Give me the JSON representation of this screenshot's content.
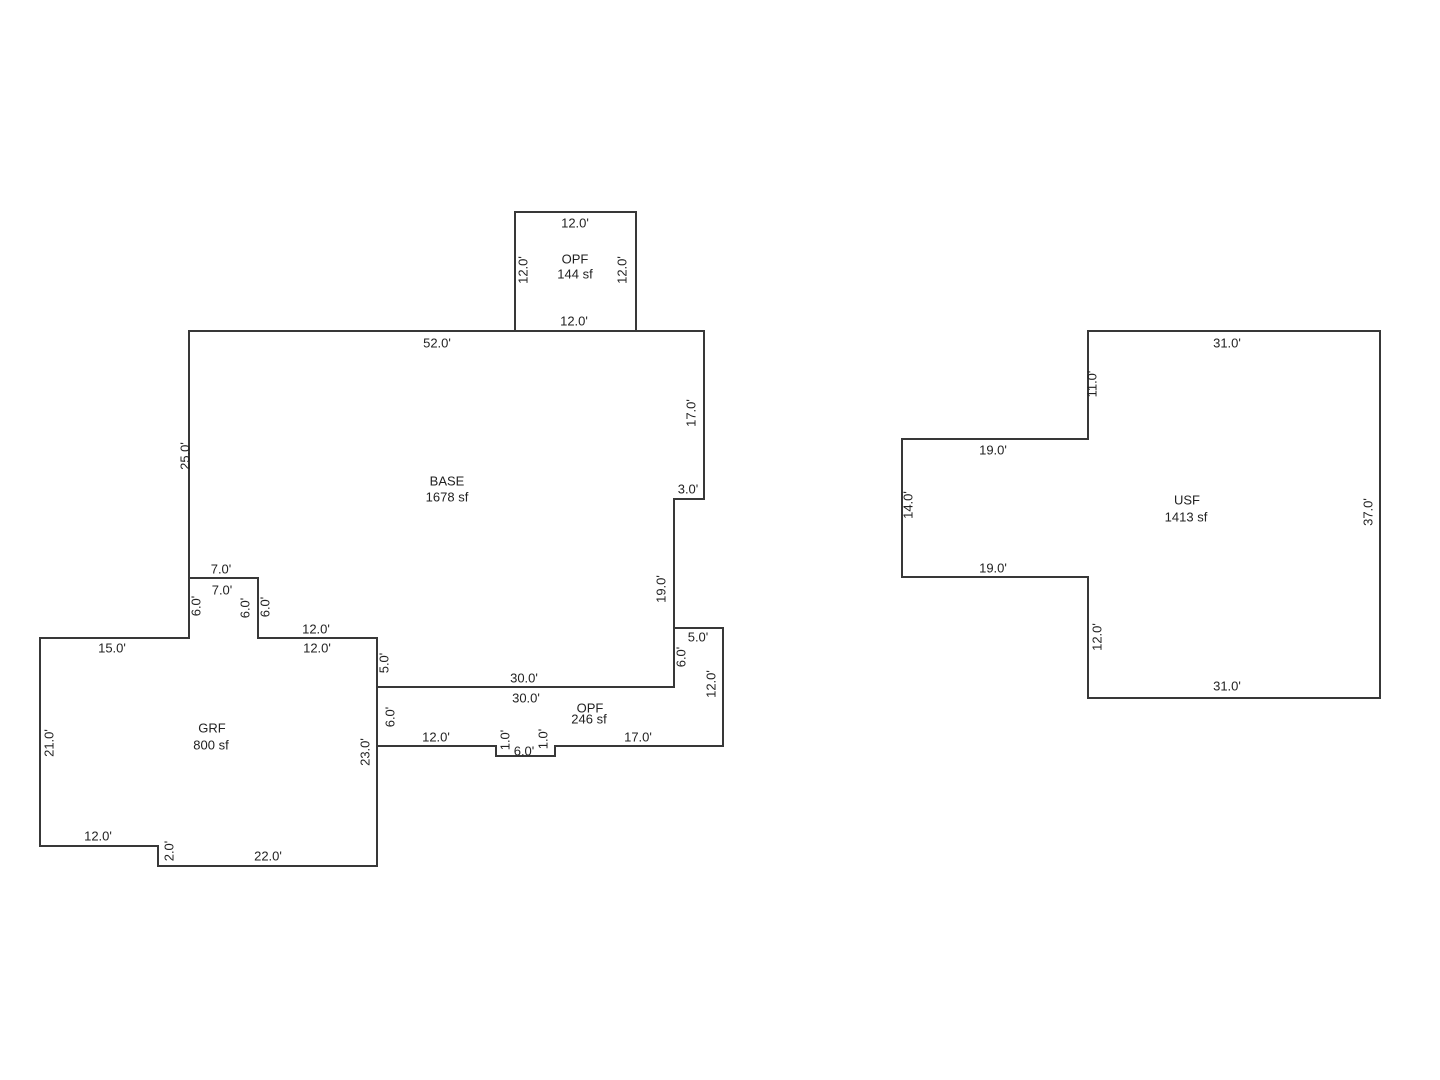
{
  "sketch": {
    "title": "Floor plan sketch",
    "canvas": {
      "width": 1440,
      "height": 1080,
      "background": "#ffffff"
    },
    "colors": {
      "line": "#383838",
      "text": "#222222"
    },
    "areas": [
      {
        "id": "opf-upper",
        "name": "OPF",
        "square_feet": "144 sf",
        "name_pos": [
          575,
          259
        ],
        "sf_pos": [
          575,
          274
        ],
        "points": [
          [
            515,
            212
          ],
          [
            636,
            212
          ],
          [
            636,
            331
          ],
          [
            515,
            331
          ]
        ],
        "dimensions": [
          {
            "text": "12.0'",
            "x": 575,
            "y": 223,
            "rot": 0
          },
          {
            "text": "12.0'",
            "x": 523,
            "y": 270,
            "rot": 90
          },
          {
            "text": "12.0'",
            "x": 622,
            "y": 270,
            "rot": 90
          },
          {
            "text": "12.0'",
            "x": 574,
            "y": 321,
            "rot": 0
          }
        ]
      },
      {
        "id": "base",
        "name": "BASE",
        "square_feet": "1678 sf",
        "name_pos": [
          447,
          481
        ],
        "sf_pos": [
          447,
          497
        ],
        "points": [
          [
            189,
            331
          ],
          [
            704,
            331
          ],
          [
            704,
            499
          ],
          [
            674,
            499
          ],
          [
            674,
            687
          ],
          [
            377,
            687
          ],
          [
            377,
            638
          ],
          [
            258,
            638
          ],
          [
            258,
            578
          ],
          [
            189,
            578
          ]
        ],
        "dimensions": [
          {
            "text": "52.0'",
            "x": 437,
            "y": 343,
            "rot": 0
          },
          {
            "text": "25.0'",
            "x": 185,
            "y": 456,
            "rot": 90
          },
          {
            "text": "17.0'",
            "x": 691,
            "y": 413,
            "rot": 90
          },
          {
            "text": "3.0'",
            "x": 688,
            "y": 489,
            "rot": 0
          },
          {
            "text": "19.0'",
            "x": 661,
            "y": 589,
            "rot": 90
          },
          {
            "text": "30.0'",
            "x": 524,
            "y": 678,
            "rot": 0
          },
          {
            "text": "5.0'",
            "x": 384,
            "y": 663,
            "rot": 90
          },
          {
            "text": "12.0'",
            "x": 316,
            "y": 629,
            "rot": 0
          },
          {
            "text": "6.0'",
            "x": 245,
            "y": 608,
            "rot": 90
          },
          {
            "text": "7.0'",
            "x": 221,
            "y": 569,
            "rot": 0
          }
        ]
      },
      {
        "id": "grf",
        "name": "GRF",
        "square_feet": "800 sf",
        "name_pos": [
          212,
          728
        ],
        "sf_pos": [
          211,
          745
        ],
        "points": [
          [
            40,
            638
          ],
          [
            189,
            638
          ],
          [
            189,
            578
          ],
          [
            258,
            578
          ],
          [
            258,
            638
          ],
          [
            377,
            638
          ],
          [
            377,
            866
          ],
          [
            158,
            866
          ],
          [
            158,
            846
          ],
          [
            40,
            846
          ]
        ],
        "dimensions": [
          {
            "text": "15.0'",
            "x": 112,
            "y": 648,
            "rot": 0
          },
          {
            "text": "7.0'",
            "x": 222,
            "y": 590,
            "rot": 0
          },
          {
            "text": "6.0'",
            "x": 196,
            "y": 606,
            "rot": 90
          },
          {
            "text": "6.0'",
            "x": 265,
            "y": 607,
            "rot": 90
          },
          {
            "text": "12.0'",
            "x": 317,
            "y": 648,
            "rot": 0
          },
          {
            "text": "23.0'",
            "x": 365,
            "y": 752,
            "rot": 90
          },
          {
            "text": "22.0'",
            "x": 268,
            "y": 856,
            "rot": 0
          },
          {
            "text": "2.0'",
            "x": 169,
            "y": 851,
            "rot": 90
          },
          {
            "text": "12.0'",
            "x": 98,
            "y": 836,
            "rot": 0
          },
          {
            "text": "21.0'",
            "x": 49,
            "y": 743,
            "rot": 90
          }
        ]
      },
      {
        "id": "opf-lower",
        "name": "OPF",
        "square_feet": "246 sf",
        "name_pos": [
          590,
          708
        ],
        "sf_pos": [
          589,
          719
        ],
        "points": [
          [
            377,
            687
          ],
          [
            674,
            687
          ],
          [
            674,
            628
          ],
          [
            723,
            628
          ],
          [
            723,
            746
          ],
          [
            555,
            746
          ],
          [
            555,
            756
          ],
          [
            496,
            756
          ],
          [
            496,
            746
          ],
          [
            377,
            746
          ]
        ],
        "dimensions": [
          {
            "text": "30.0'",
            "x": 526,
            "y": 698,
            "rot": 0
          },
          {
            "text": "6.0'",
            "x": 681,
            "y": 657,
            "rot": 90
          },
          {
            "text": "5.0'",
            "x": 698,
            "y": 637,
            "rot": 0
          },
          {
            "text": "12.0'",
            "x": 711,
            "y": 684,
            "rot": 90
          },
          {
            "text": "17.0'",
            "x": 638,
            "y": 737,
            "rot": 0
          },
          {
            "text": "1.0'",
            "x": 543,
            "y": 739,
            "rot": 90
          },
          {
            "text": "6.0'",
            "x": 524,
            "y": 751,
            "rot": 0
          },
          {
            "text": "1.0'",
            "x": 505,
            "y": 740,
            "rot": 90
          },
          {
            "text": "12.0'",
            "x": 436,
            "y": 737,
            "rot": 0
          },
          {
            "text": "6.0'",
            "x": 390,
            "y": 717,
            "rot": 90
          }
        ]
      },
      {
        "id": "usf",
        "name": "USF",
        "square_feet": "1413 sf",
        "name_pos": [
          1187,
          500
        ],
        "sf_pos": [
          1186,
          517
        ],
        "points": [
          [
            1088,
            331
          ],
          [
            1380,
            331
          ],
          [
            1380,
            698
          ],
          [
            1088,
            698
          ],
          [
            1088,
            577
          ],
          [
            902,
            577
          ],
          [
            902,
            439
          ],
          [
            1088,
            439
          ]
        ],
        "dimensions": [
          {
            "text": "31.0'",
            "x": 1227,
            "y": 343,
            "rot": 0
          },
          {
            "text": "11.0'",
            "x": 1092,
            "y": 384,
            "rot": 90
          },
          {
            "text": "19.0'",
            "x": 993,
            "y": 450,
            "rot": 0
          },
          {
            "text": "14.0'",
            "x": 908,
            "y": 505,
            "rot": 90
          },
          {
            "text": "19.0'",
            "x": 993,
            "y": 568,
            "rot": 0
          },
          {
            "text": "12.0'",
            "x": 1097,
            "y": 637,
            "rot": 90
          },
          {
            "text": "31.0'",
            "x": 1227,
            "y": 686,
            "rot": 0
          },
          {
            "text": "37.0'",
            "x": 1368,
            "y": 512,
            "rot": 90
          }
        ]
      }
    ]
  }
}
